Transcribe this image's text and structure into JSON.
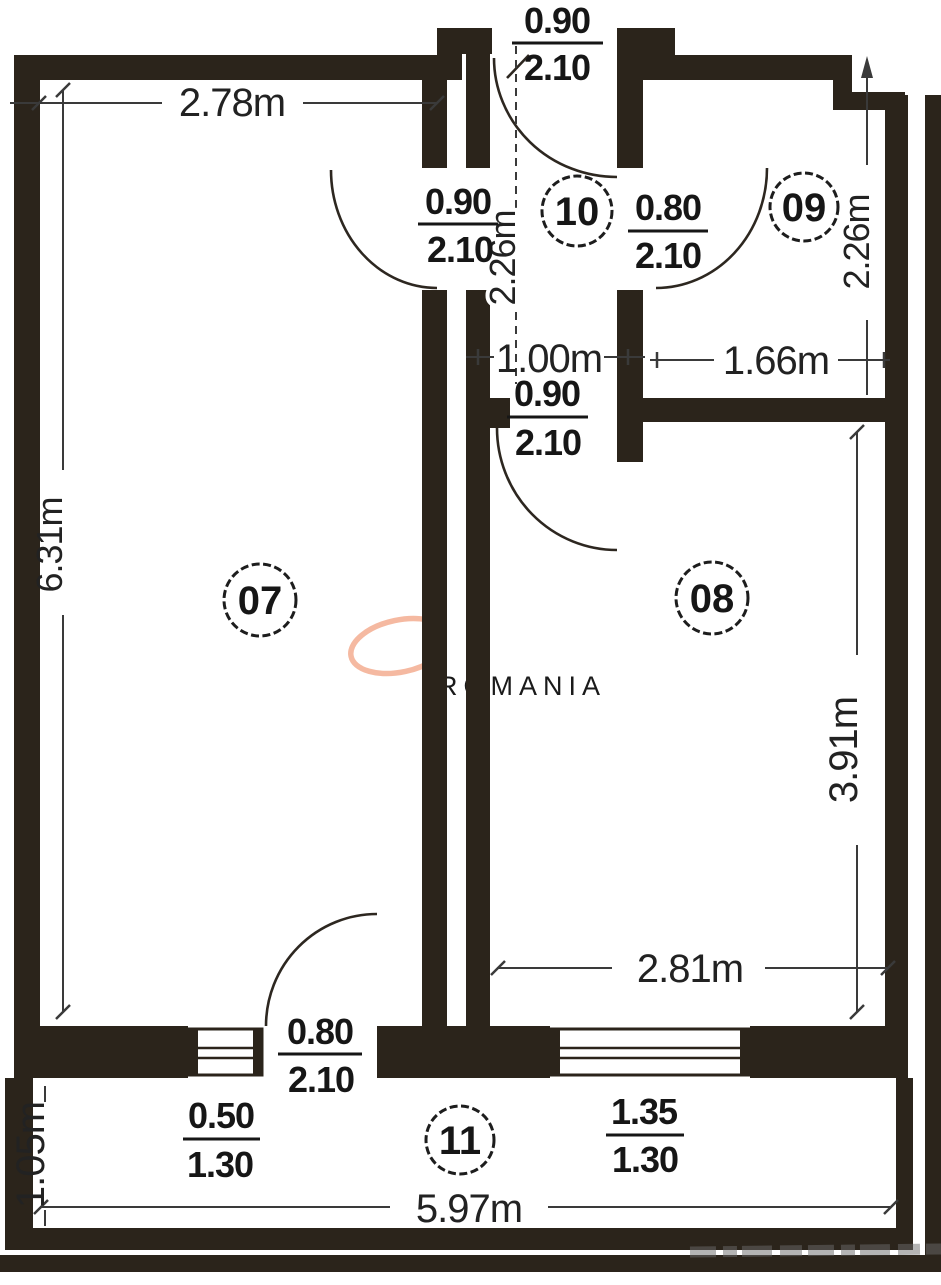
{
  "plan": {
    "rooms": [
      {
        "number": "07"
      },
      {
        "number": "08"
      },
      {
        "number": "09"
      },
      {
        "number": "10"
      },
      {
        "number": "11"
      }
    ],
    "dimensions": {
      "room07_width": "2.78m",
      "room07_height": "6.31m",
      "hall_length": "2.26m",
      "hall_width": "1.00m",
      "room09_height": "2.26m",
      "room09_width": "1.66m",
      "room08_height": "3.91m",
      "room08_width": "2.81m",
      "balcony_depth": "1.05m",
      "balcony_width": "5.97m"
    },
    "openings": {
      "entrance_door": {
        "num": "0.90",
        "den": "2.10"
      },
      "room07_door": {
        "num": "0.90",
        "den": "2.10"
      },
      "room09_door": {
        "num": "0.80",
        "den": "2.10"
      },
      "room08_door": {
        "num": "0.90",
        "den": "2.10"
      },
      "balcony_door": {
        "num": "0.80",
        "den": "2.10"
      },
      "balcony_window_small": {
        "num": "0.50",
        "den": "1.30"
      },
      "balcony_window_large": {
        "num": "1.35",
        "den": "1.30"
      }
    },
    "watermark": {
      "text": "ROMANIA",
      "accent_color": "#f5b9a1"
    },
    "colors": {
      "wall": "#2b241b",
      "dimension_line": "#3a3a3a",
      "text": "#1a1a1a"
    }
  }
}
